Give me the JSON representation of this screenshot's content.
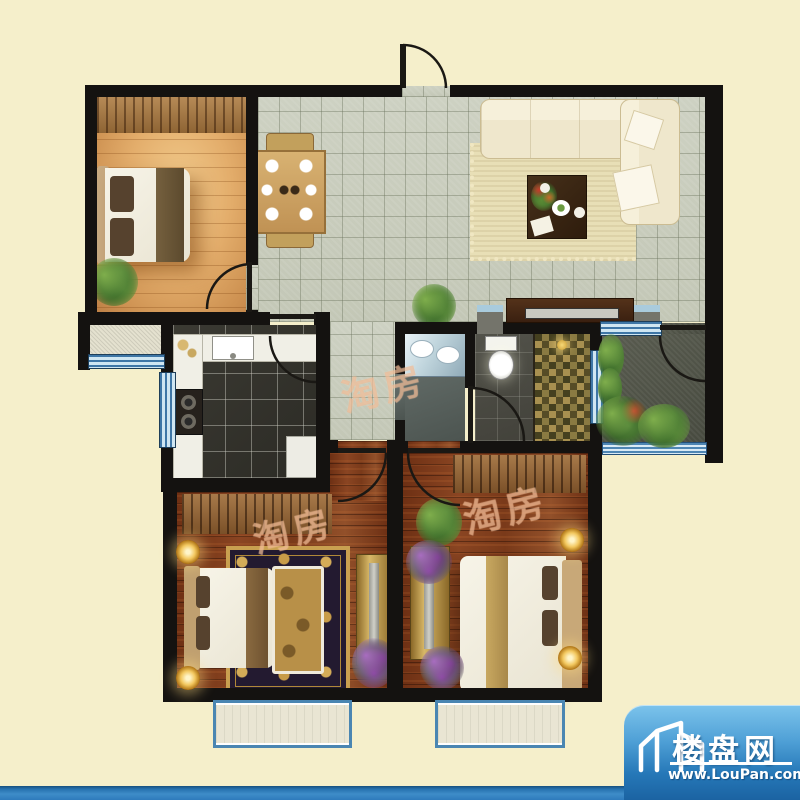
{
  "canvas": {
    "width": 800,
    "height": 800
  },
  "branding": {
    "site_name": "楼盘网",
    "site_url": "www.LouPan.com",
    "watermark_text": "淘房"
  },
  "palette": {
    "background": "#F5EFCB",
    "wall": "#141210",
    "tile_floor": "#C8CCBC",
    "light_wood_floor": "#DFA768",
    "dark_wood_floor": "#7E3C1C",
    "kitchen_floor": "#34332D",
    "bathroom_floor": "#4A4A42",
    "terrace_floor": "#53564B",
    "window_blue": "#7FB3D9",
    "bottom_bar_blue": "#2E7ABC",
    "badge_blue_top": "#7CC4EC",
    "badge_blue_bottom": "#1B63A2"
  }
}
